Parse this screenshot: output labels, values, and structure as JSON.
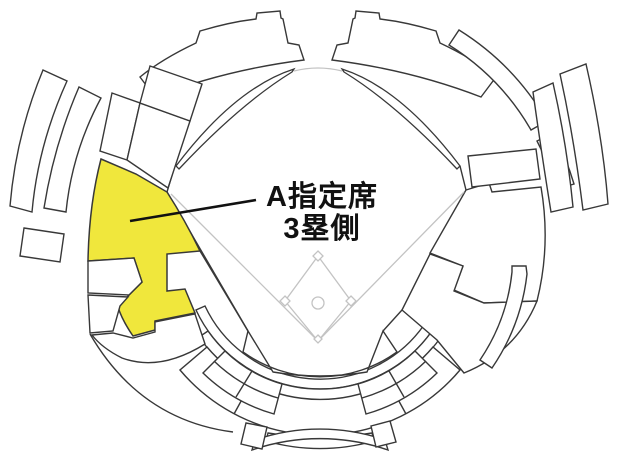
{
  "map": {
    "type": "stadium-seating-map",
    "sport": "baseball",
    "label": {
      "line1": "A指定席",
      "line2": "3塁側"
    },
    "highlight": {
      "section_name": "A指定席 3塁側",
      "side": "third-base-side",
      "color": "#F0E73C"
    },
    "colors": {
      "background": "#FFFFFF",
      "section_fill": "#FFFFFF",
      "outline": "#383838",
      "field_line": "#C3C3C3",
      "label_text": "#111111",
      "leader_line": "#111111"
    }
  }
}
